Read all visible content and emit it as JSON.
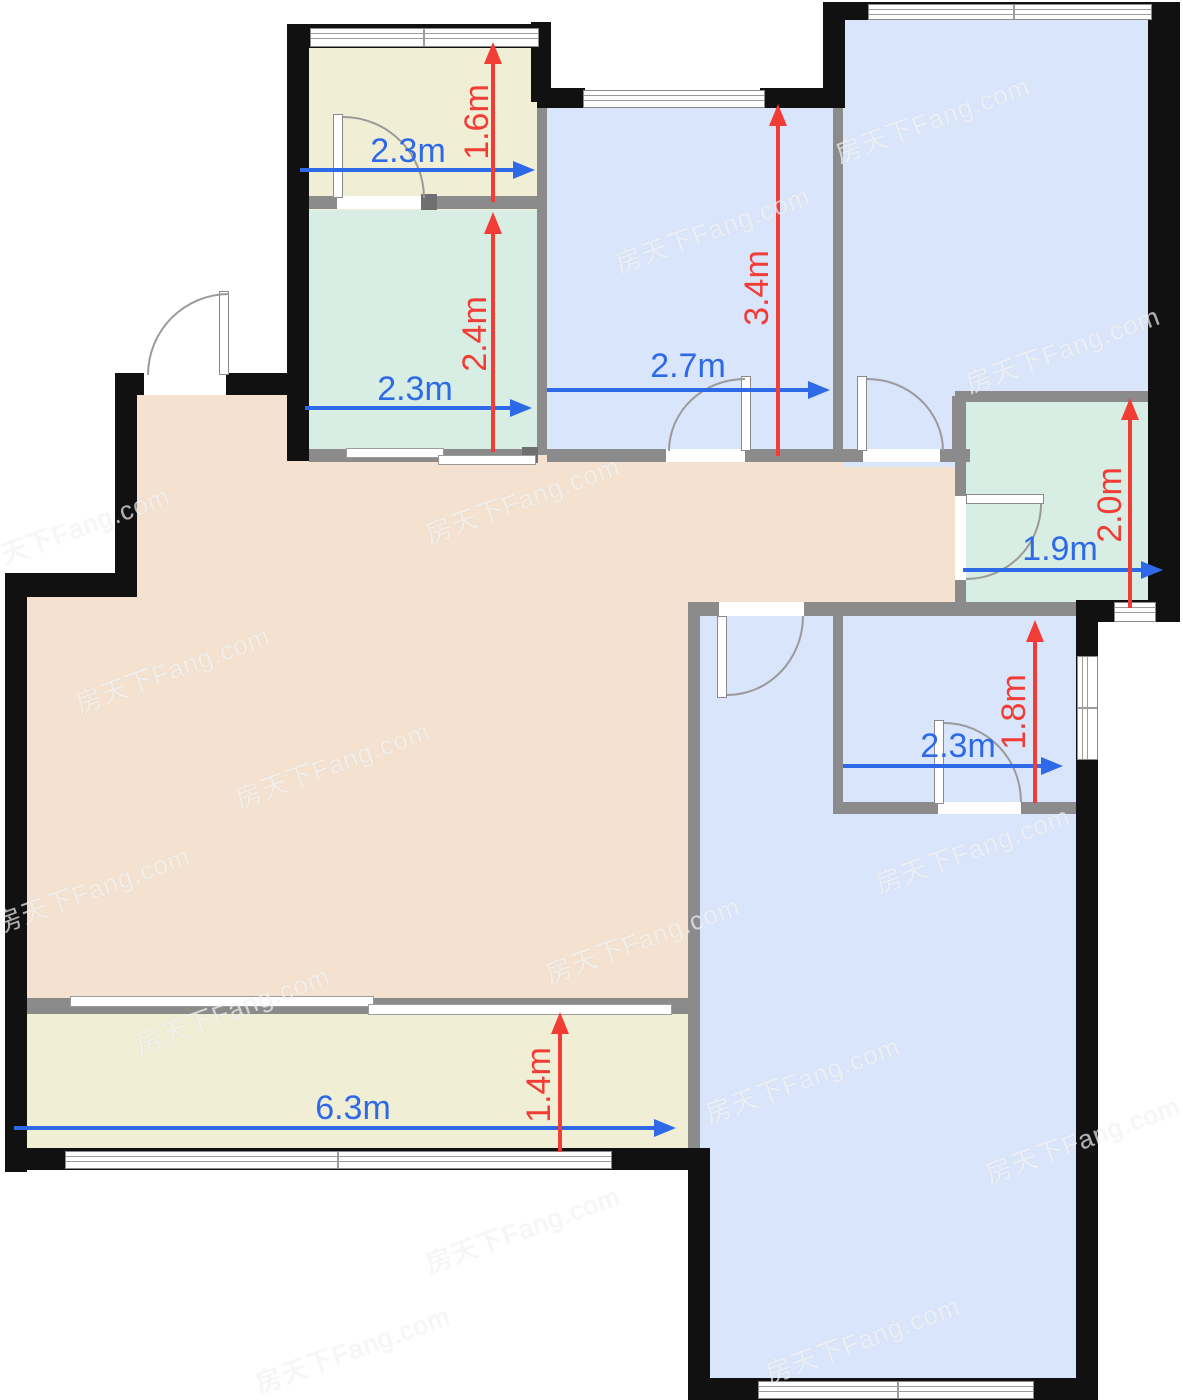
{
  "watermark": {
    "text": "房天下Fang.com"
  },
  "colors": {
    "wall": "#111111",
    "partition": "#8b8b8b",
    "blue_room": "#d9e5fb",
    "green_room": "#d8ede3",
    "cream_room": "#f1eed6",
    "peach_room": "#f4e1cf",
    "dimension_blue": "#2e6ae8",
    "dimension_red": "#f23c36"
  },
  "rooms": {
    "balcony_top": {
      "w": "2.3m",
      "h": "1.6m"
    },
    "kitchen": {
      "w": "2.3m",
      "h": "2.4m"
    },
    "bedroom_middle": {
      "w": "2.7m",
      "h": "3.4m"
    },
    "bathroom": {
      "w": "1.9m",
      "h": "2.0m"
    },
    "storage": {
      "w": "2.3m",
      "h": "1.8m"
    },
    "balcony_bottom": {
      "w": "6.3m",
      "h": "1.4m"
    }
  }
}
